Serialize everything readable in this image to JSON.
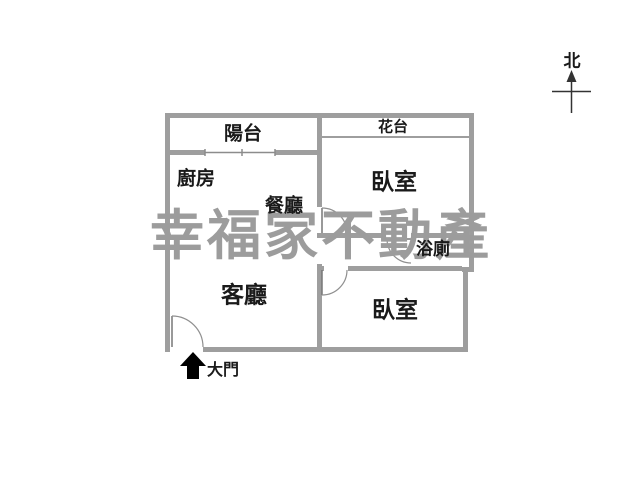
{
  "plan": {
    "north_label": "北",
    "entrance_label": "大門",
    "rooms": {
      "balcony": "陽台",
      "flower_terrace": "花台",
      "kitchen": "廚房",
      "dining_room": "餐廳",
      "bedroom_top": "臥室",
      "bathroom": "浴廁",
      "living_room": "客廳",
      "bedroom_bottom": "臥室"
    }
  },
  "watermark": {
    "text": "幸福家不動產",
    "color": "#9c9c9c"
  },
  "colors": {
    "wall": "#9e9e9e",
    "thin_line": "#8c8c8c",
    "label": "#1a1a1a",
    "arrow": "#000000",
    "background": "#ffffff"
  }
}
